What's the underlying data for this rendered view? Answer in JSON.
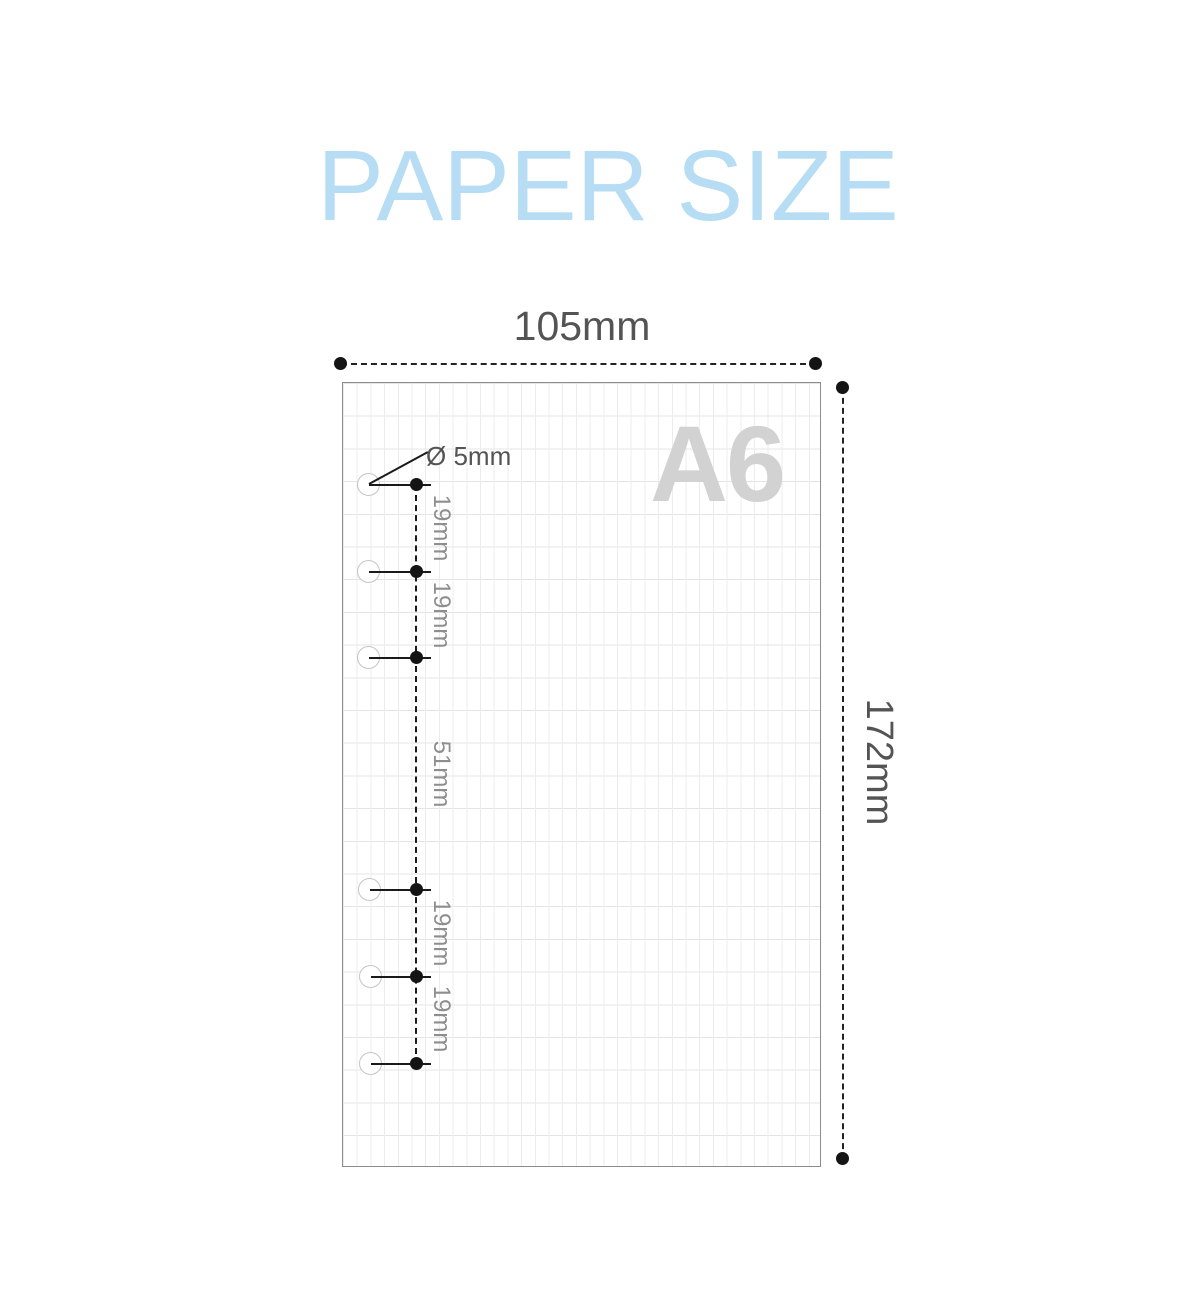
{
  "title": "PAPER SIZE",
  "paper": {
    "format_label": "A6",
    "width_label": "105mm",
    "height_label": "172mm",
    "hole_diameter_label": "Ø 5mm",
    "hole_count": 6,
    "hole_spacing_labels": [
      "19mm",
      "19mm",
      "51mm",
      "19mm",
      "19mm"
    ]
  },
  "colors": {
    "title_blue": "#b6ddf4",
    "watermark_gray": "#d2d2d2",
    "dimension_text": "#545454",
    "spacing_text": "#8e8e8e",
    "line_black": "#1a1a1a",
    "grid_line": "#e8e8e8",
    "paper_border": "#8c8c8c"
  }
}
